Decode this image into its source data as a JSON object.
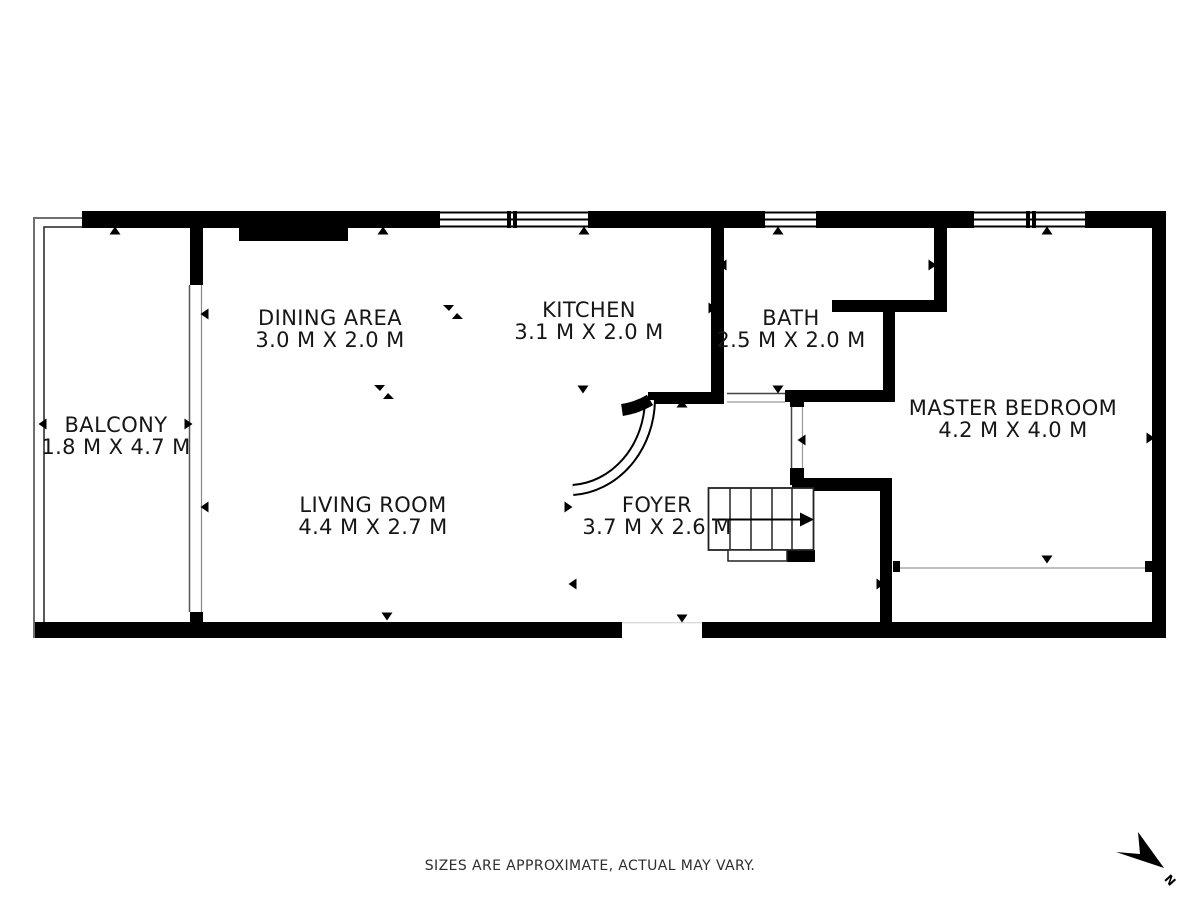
{
  "title": "Apartment floor plan",
  "rooms": [
    {
      "name": "BALCONY",
      "dims": "1.8 M X 4.7 M"
    },
    {
      "name": "DINING AREA",
      "dims": "3.0 M X 2.0 M"
    },
    {
      "name": "KITCHEN",
      "dims": "3.1 M X 2.0 M"
    },
    {
      "name": "BATH",
      "dims": "2.5 M X 2.0 M"
    },
    {
      "name": "MASTER BEDROOM",
      "dims": "4.2 M X 4.0 M"
    },
    {
      "name": "LIVING ROOM",
      "dims": "4.4 M X 2.7 M"
    },
    {
      "name": "FOYER",
      "dims": "3.7 M X 2.6 M"
    }
  ],
  "footer": {
    "disclaimer": "SIZES ARE APPROXIMATE, ACTUAL MAY VARY."
  },
  "compass": {
    "label": "N"
  },
  "colors": {
    "wall": "#000000",
    "text": "#161616",
    "railing": "#6f6f6f",
    "thin_line": "#555555",
    "background": "#ffffff"
  }
}
